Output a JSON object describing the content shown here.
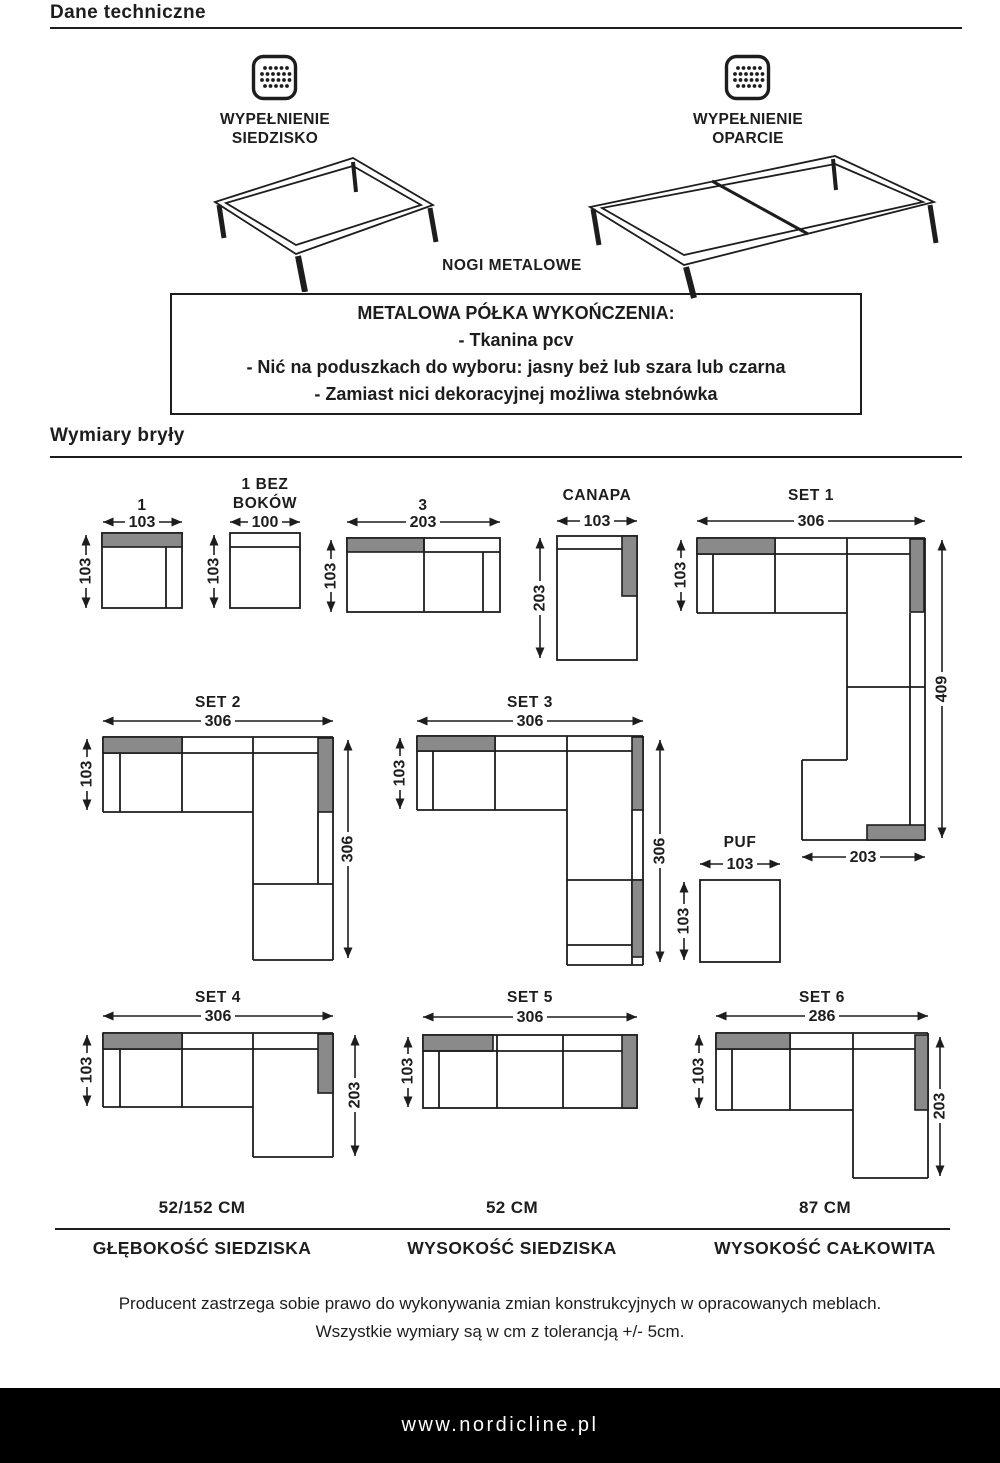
{
  "header": {
    "title": "Dane techniczne"
  },
  "fillings": {
    "seat_label_line1": "WYPEŁNIENIE",
    "seat_label_line2": "SIEDZISKO",
    "back_label_line1": "WYPEŁNIENIE",
    "back_label_line2": "OPARCIE",
    "legs_label": "NOGI METALOWE"
  },
  "finish_box": {
    "title": "METALOWA PÓŁKA WYKOŃCZENIA:",
    "items": [
      "- Tkanina pcv",
      "- Nić na poduszkach do wyboru: jasny beż lub szara lub czarna",
      "- Zamiast nici dekoracyjnej możliwa stebnówka"
    ]
  },
  "dimensions_section": {
    "title": "Wymiary bryły"
  },
  "diagrams": {
    "d1": {
      "label": "1",
      "width": "103",
      "height": "103"
    },
    "d1_bez_bokow": {
      "label_line1": "1 BEZ",
      "label_line2": "BOKÓW",
      "width": "100",
      "height": "103"
    },
    "d3": {
      "label": "3",
      "width": "203",
      "height": "103"
    },
    "canapa": {
      "label": "CANAPA",
      "width": "103",
      "height": "203"
    },
    "set1": {
      "label": "SET 1",
      "width": "306",
      "height": "103",
      "total_height": "409",
      "chaise_width": "203"
    },
    "set2": {
      "label": "SET 2",
      "width": "306",
      "height": "103",
      "total_height": "306"
    },
    "set3": {
      "label": "SET 3",
      "width": "306",
      "height": "103",
      "total_height": "306"
    },
    "puf": {
      "label": "PUF",
      "width": "103",
      "height": "103"
    },
    "set4": {
      "label": "SET 4",
      "width": "306",
      "height": "103",
      "total_height": "203"
    },
    "set5": {
      "label": "SET 5",
      "width": "306",
      "height": "103"
    },
    "set6": {
      "label": "SET 6",
      "width": "286",
      "height": "103",
      "total_height": "203"
    }
  },
  "stats": [
    {
      "value": "52/152 CM",
      "label": "GŁĘBOKOŚĆ SIEDZISKA"
    },
    {
      "value": "52 CM",
      "label": "WYSOKOŚĆ SIEDZISKA"
    },
    {
      "value": "87 CM",
      "label": "WYSOKOŚĆ CAŁKOWITA"
    }
  ],
  "disclaimer": {
    "line1": "Producent zastrzega sobie prawo do wykonywania zmian konstrukcyjnych w opracowanych meblach.",
    "line2": "Wszystkie wymiary są w cm z tolerancją +/- 5cm."
  },
  "footer": {
    "url": "www.nordicline.pl"
  },
  "colors": {
    "ink": "#1d1d1d",
    "gray_fill": "#8a8a8a",
    "footer_bg": "#000000"
  }
}
